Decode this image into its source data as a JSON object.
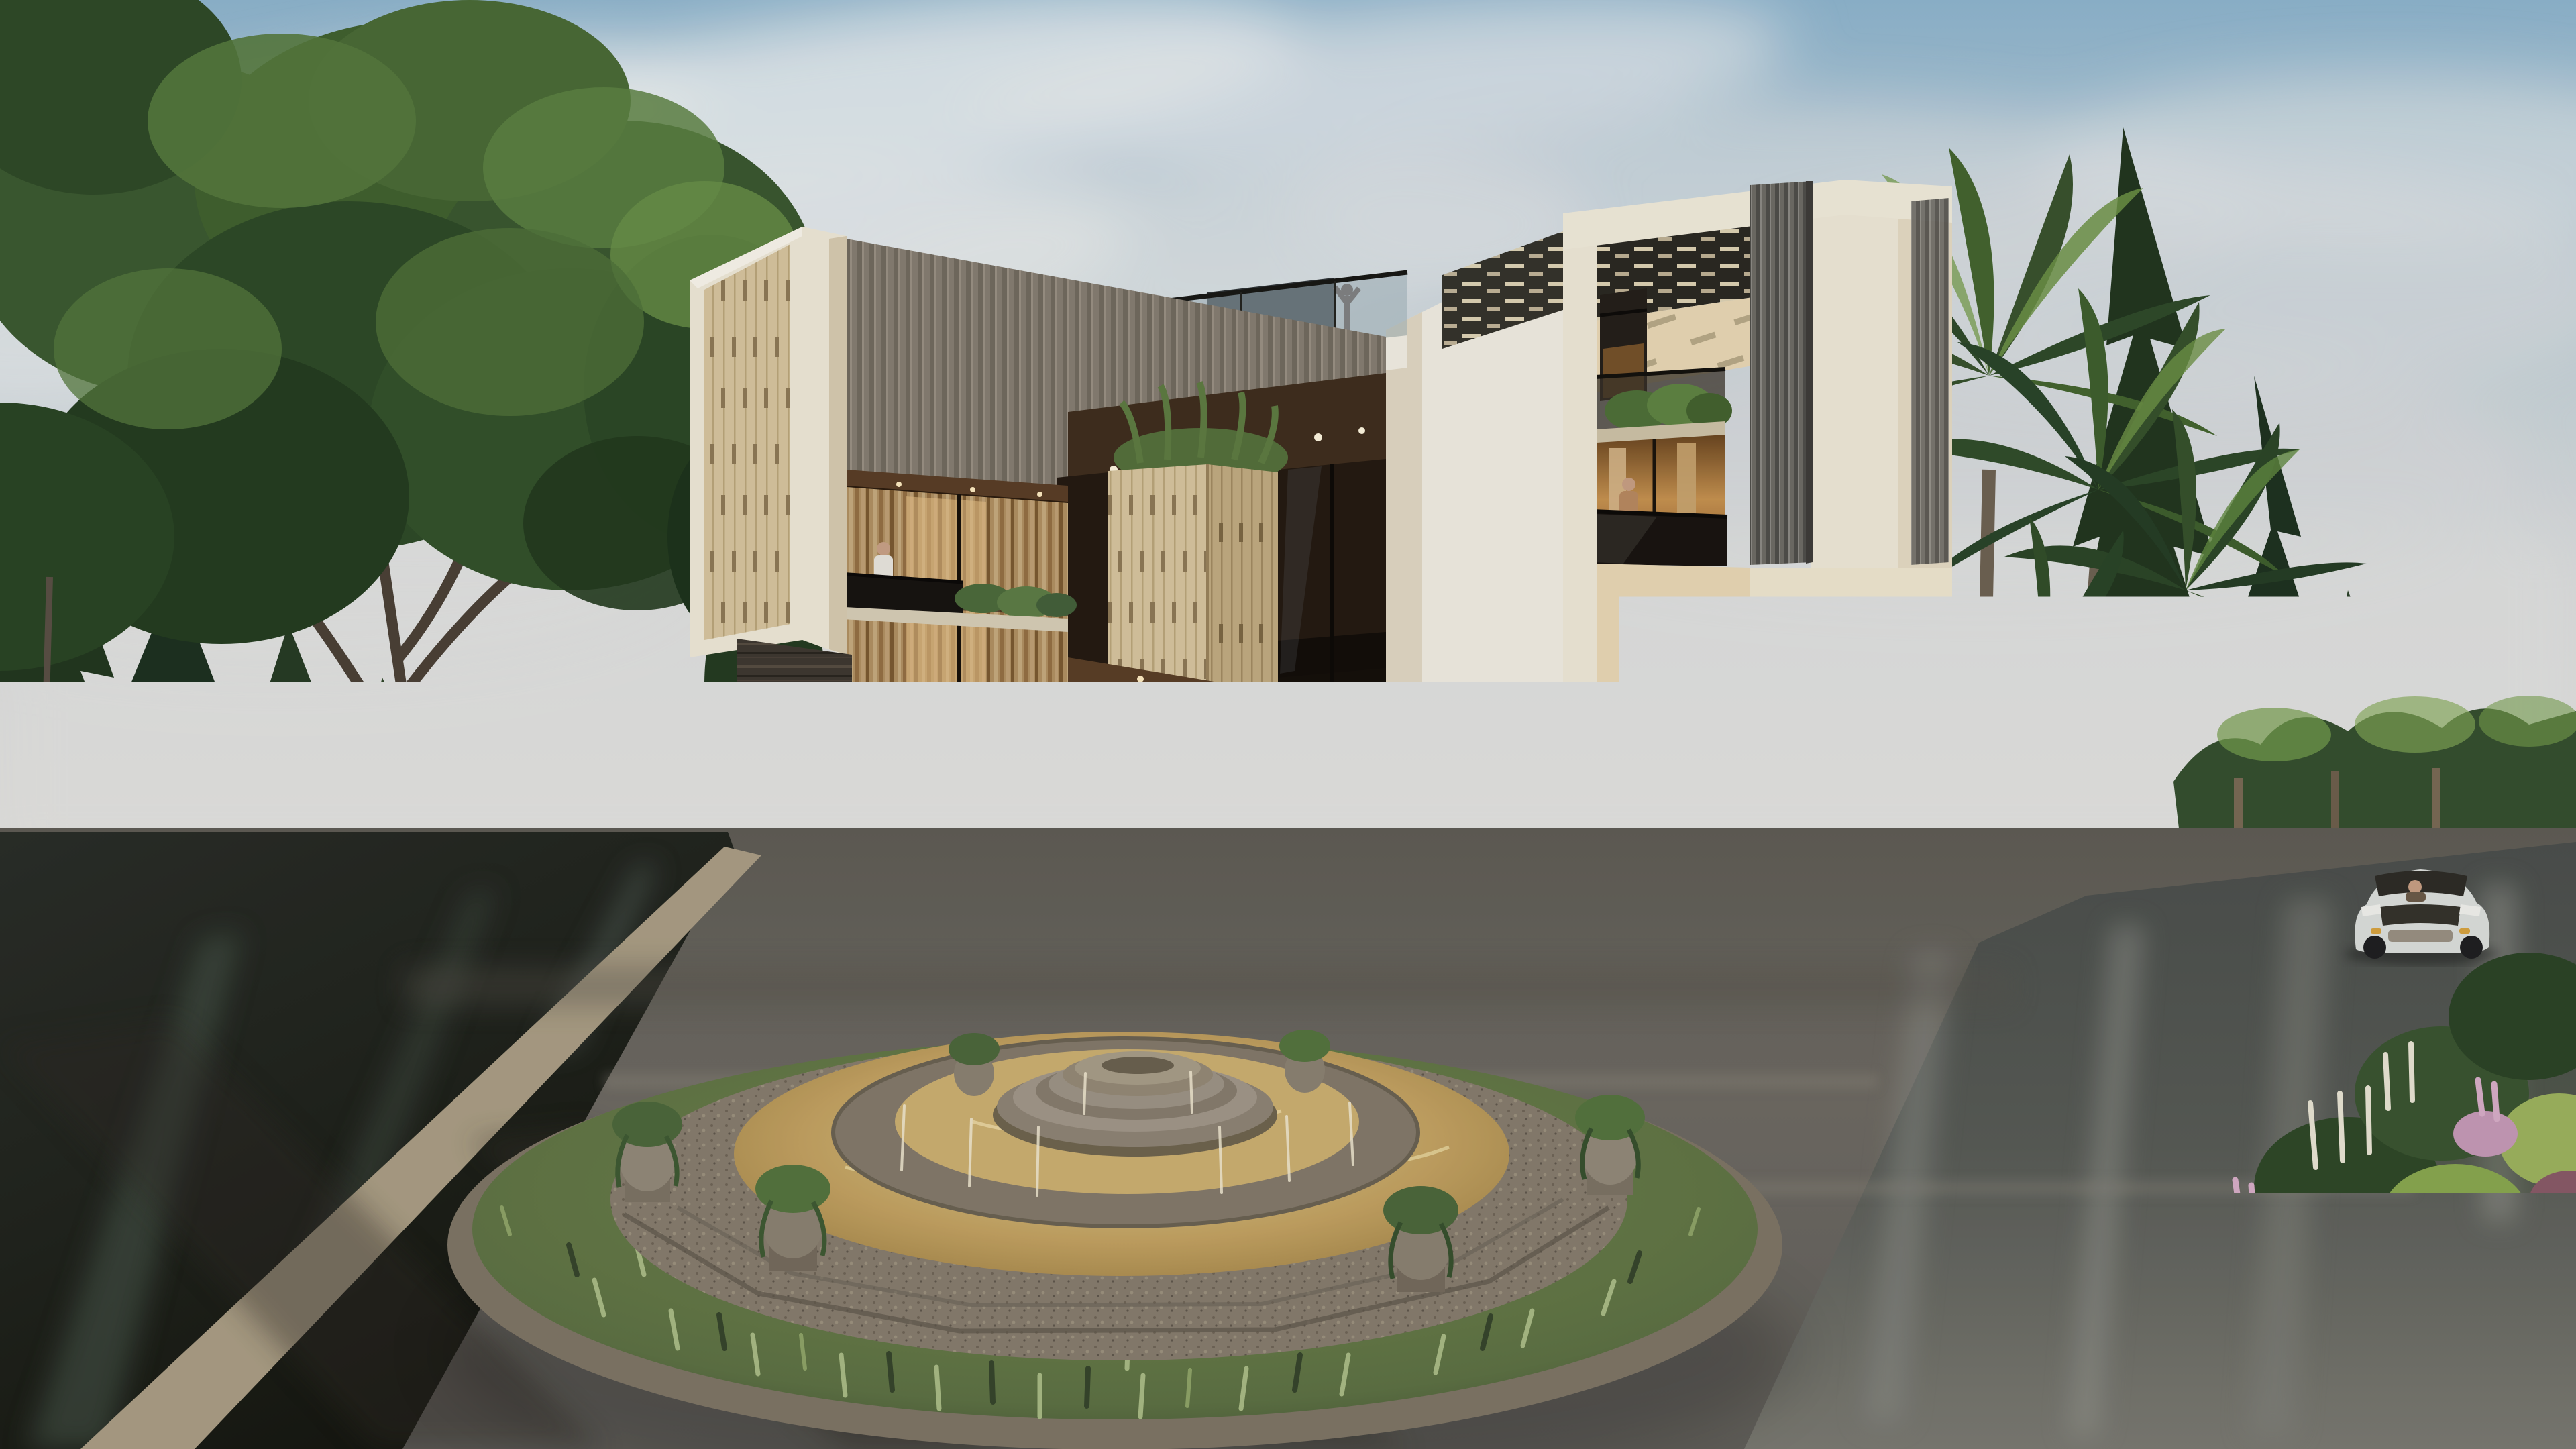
{
  "scene": {
    "type": "architectural-exterior-3d-render",
    "subject": "modern three-storey luxury villa",
    "environment": "forest-edge corner plot with circular fountain roundabout on wet asphalt streets",
    "lighting": "soft daylight, partly cloudy sky, wet reflective roads"
  },
  "palette": {
    "sky_top": "#8fb6cf",
    "sky_mid": "#c2d0d8",
    "sky_horizon": "#e7e5e1",
    "cloud": "#eceff1",
    "building_cream": "#f0e9d8",
    "building_cream_shade": "#ddd2ba",
    "building_cream_warm": "#ead9b6",
    "building_white": "#f2eee3",
    "slat_gray": "#8e8679",
    "slat_column": "#6e6c66",
    "travertine": "#d8c6a0",
    "travertine_dark": "#c2ac82",
    "pergola_dark": "#2b2922",
    "soffit_wood": "#402e1e",
    "glass_dark": "#241a11",
    "interior_warm": "#c89350",
    "curtain_beige": "#d6b689",
    "stone_cladding_dark": "#3f3831",
    "compound_wall": "#95897a",
    "compound_wall_dark": "#5b544b",
    "boundary_wall_cream": "#dbcfb5",
    "road_left_dark": "#23261f",
    "road_center": "#6e6a63",
    "road_right": "#585b56",
    "curb": "#ab9e85",
    "lawn_green": "#8fa54a",
    "tree_dark": "#263c24",
    "tree_mid": "#3e5c33",
    "tree_highlight": "#78a04f",
    "palm_green": "#39532e",
    "palm_light": "#6f9447",
    "blossom_pink": "#b68c9e",
    "astilbe_pink": "#c79ab8",
    "flower_white": "#e9e5d4",
    "foliage_purple": "#74495a",
    "fountain_stone": "#877d6e",
    "fountain_stone_dark": "#5f574c",
    "fountain_water_gold": "#c3a261",
    "fountain_water_light": "#e4d097",
    "fountain_ring_grass": "#5d7144",
    "car_red": "#a03029",
    "car_silver": "#c7cbcf",
    "car_white": "#dde0dd",
    "bear_tan": "#cfa573"
  },
  "objects": {
    "building": {
      "left_tower": "cream frame tower clad with vertical travertine slats",
      "main_facade": "gray-brown vertical slat screen wall over double-height warm glazed floors",
      "center": "white cantilevered volume, rooftop glass-railed terrace, travertine pillar with planter",
      "right_tower": "tall cream portal frame with pergola lattice roof, gray louver columns, two balconies",
      "ground_floor": "floor-to-ceiling glazing with beige curtains, dark striated stone feature wall"
    },
    "fountain": {
      "form": "octagonal tiered stone fountain with golden water, corner urn planters and central tiered dome",
      "surround": "wide circular grass-and-groundcover ring with stone curb"
    },
    "vehicles": [
      {
        "name": "silver SUV parked at villa entrance"
      },
      {
        "name": "red sports car driving on left street"
      },
      {
        "name": "white SUV driving on right street"
      }
    ],
    "people": [
      {
        "name": "woman playing ball with child on terrace"
      },
      {
        "name": "two residents chatting near outdoor lounge"
      },
      {
        "name": "man on phone at left balcony"
      },
      {
        "name": "person in tan coat on right tower balcony"
      },
      {
        "name": "person stretching on rooftop terrace"
      }
    ],
    "landscape": [
      "large deciduous tree and conifer forest on the left",
      "areca palm cluster beside right tower",
      "pine forest and low tree line on the right",
      "pink blossom shrub at street corner",
      "flower bed strip with astilbe and white spikes at bottom right",
      "giant tan bear sculpture behind entrance wall"
    ]
  }
}
